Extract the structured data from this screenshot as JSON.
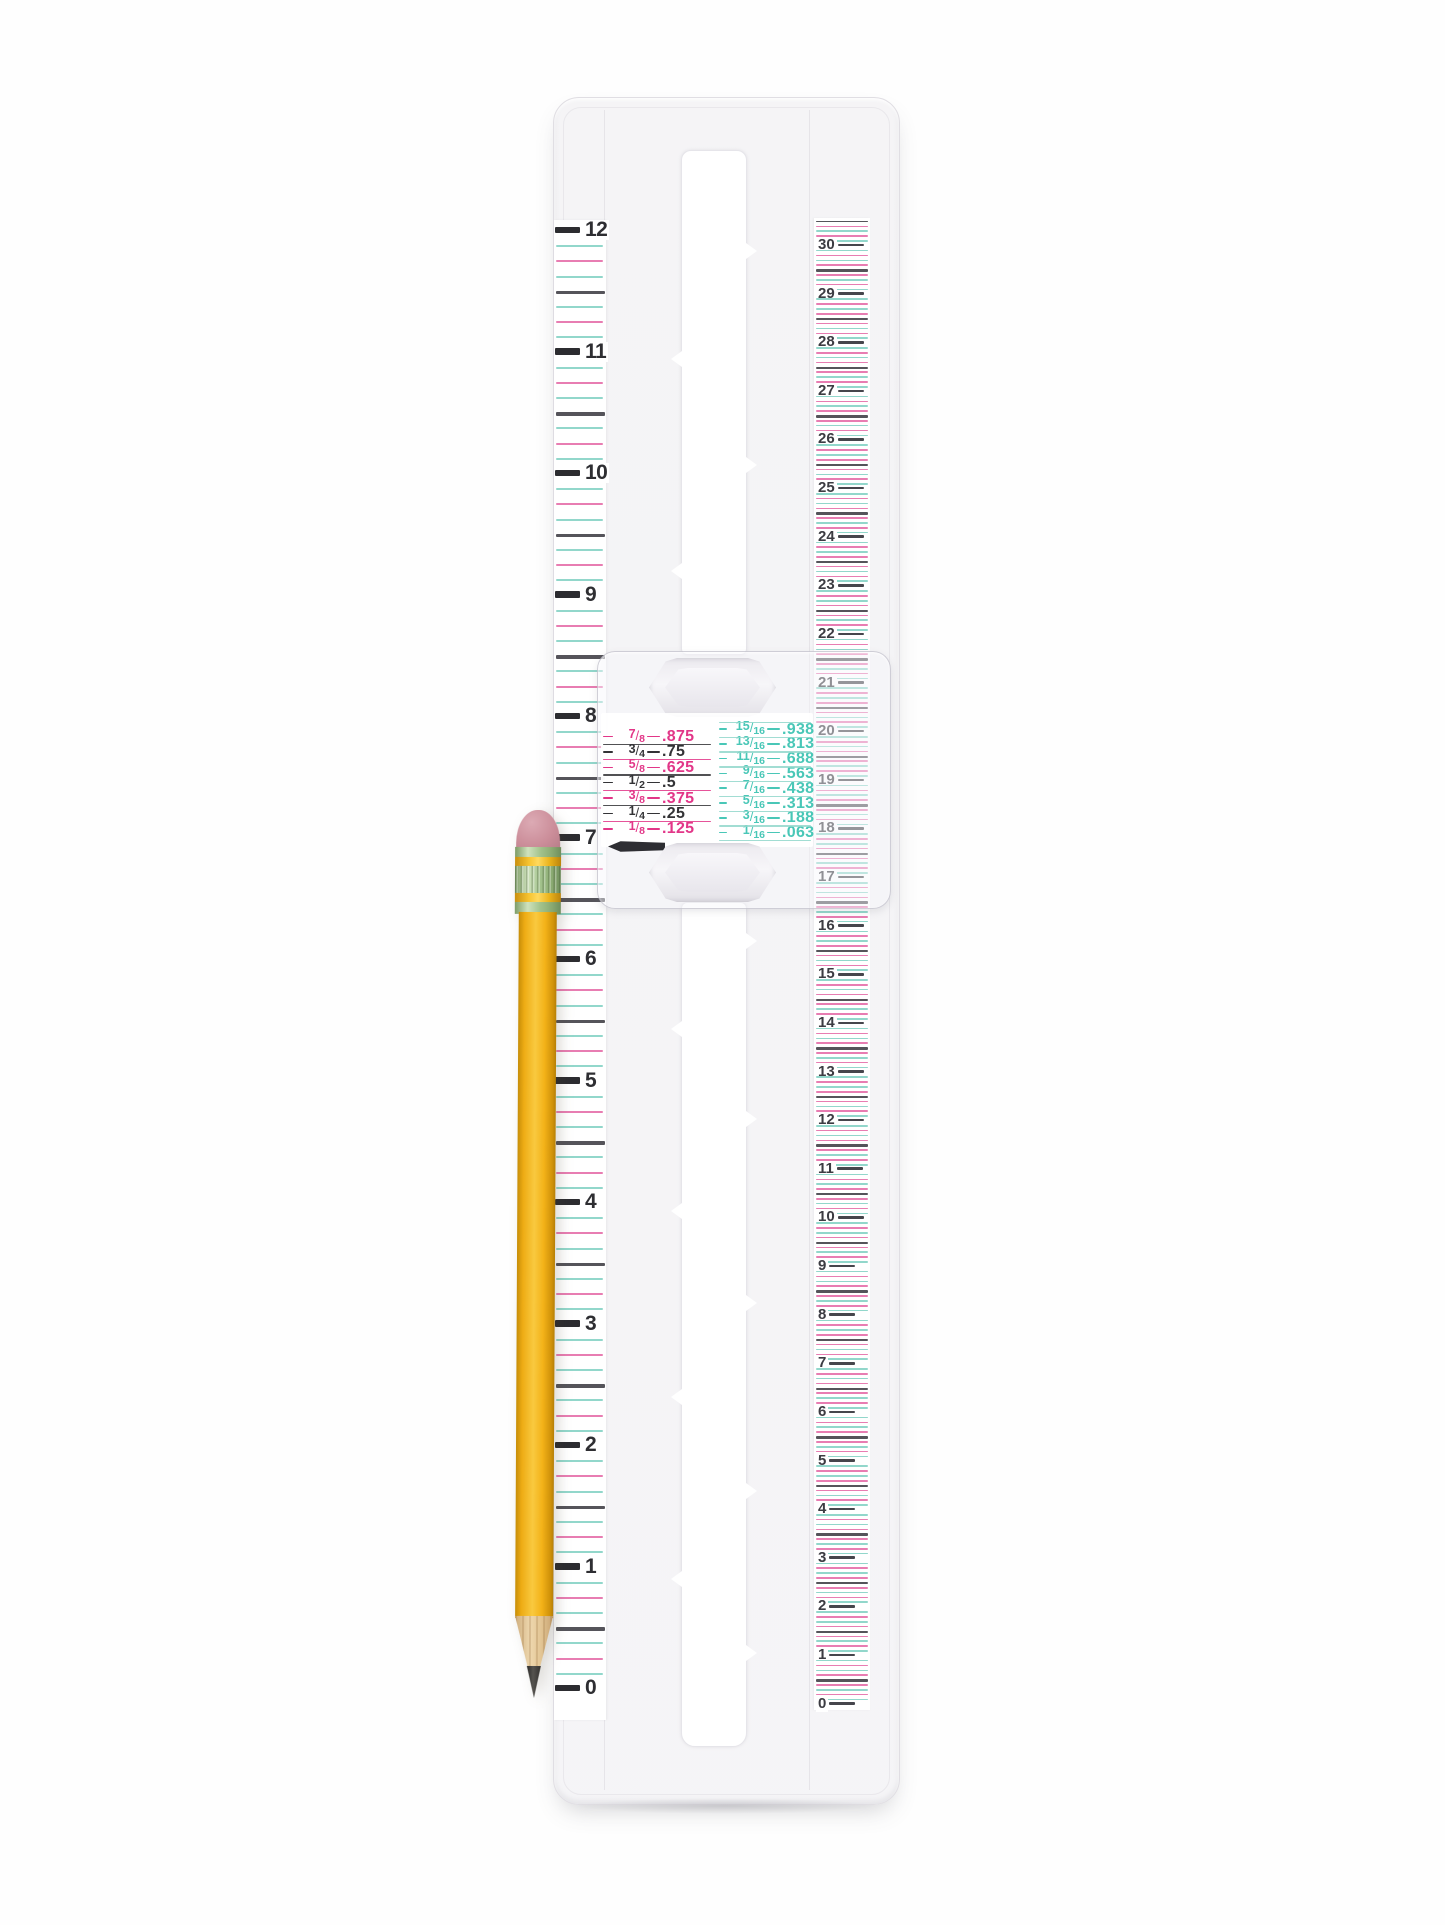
{
  "scene": {
    "type": "product-photo",
    "subject": "Clear plastic sliding measuring gauge with inch and centimeter scales, fraction-to-decimal conversion chart slider, and a sharpened yellow pencil",
    "background_color": "#fefefe"
  },
  "ruler": {
    "inch_scale": {
      "unit": "inches",
      "numbers": [
        "12",
        "11",
        "10",
        "9",
        "8",
        "7",
        "6",
        "5",
        "4",
        "3",
        "2",
        "1",
        "0"
      ],
      "minor_pattern": [
        "teal",
        "pink",
        "teal",
        "dark",
        "teal",
        "pink",
        "teal"
      ]
    },
    "cm_scale": {
      "unit": "centimeters",
      "numbers": [
        "30",
        "29",
        "28",
        "27",
        "26",
        "25",
        "24",
        "23",
        "22",
        "21",
        "20",
        "19",
        "18",
        "17",
        "16",
        "15",
        "14",
        "13",
        "12",
        "11",
        "10",
        "9",
        "8",
        "7",
        "6",
        "5",
        "4",
        "3",
        "2",
        "1",
        "0"
      ],
      "minor_pattern": [
        "teal",
        "pink",
        "teal",
        "pink",
        "dark",
        "pink",
        "teal",
        "pink",
        "teal"
      ]
    },
    "conversion_chart": {
      "left_column": [
        {
          "fraction": "7/8",
          "value": ".875",
          "color": "pink"
        },
        {
          "fraction": "3/4",
          "value": ".75",
          "color": "black"
        },
        {
          "fraction": "5/8",
          "value": ".625",
          "color": "pink"
        },
        {
          "fraction": "1/2",
          "value": ".5",
          "color": "black"
        },
        {
          "fraction": "3/8",
          "value": ".375",
          "color": "pink"
        },
        {
          "fraction": "1/4",
          "value": ".25",
          "color": "black"
        },
        {
          "fraction": "1/8",
          "value": ".125",
          "color": "pink"
        }
      ],
      "right_column": [
        {
          "fraction": "15/16",
          "value": ".938",
          "color": "teal"
        },
        {
          "fraction": "13/16",
          "value": ".813",
          "color": "teal"
        },
        {
          "fraction": "11/16",
          "value": ".688",
          "color": "teal"
        },
        {
          "fraction": "9/16",
          "value": ".563",
          "color": "teal"
        },
        {
          "fraction": "7/16",
          "value": ".438",
          "color": "teal"
        },
        {
          "fraction": "5/16",
          "value": ".313",
          "color": "teal"
        },
        {
          "fraction": "3/16",
          "value": ".188",
          "color": "teal"
        },
        {
          "fraction": "1/16",
          "value": ".063",
          "color": "teal"
        }
      ]
    },
    "colors": {
      "pink": "#e23688",
      "black": "#333336",
      "teal": "#49c7b7",
      "line_pink": "#e87db2",
      "line_teal": "#92d7cb",
      "line_dark": "#55545a",
      "tick": "#2c2c30"
    }
  },
  "pencil": {
    "body_color": "#f2b31c",
    "eraser_color": "#cb8d99",
    "ferrule_color": "#a3c38d",
    "stripe_color": "#f0bb24",
    "wood_color": "#e6cba4",
    "graphite_color": "#3e3c39"
  }
}
